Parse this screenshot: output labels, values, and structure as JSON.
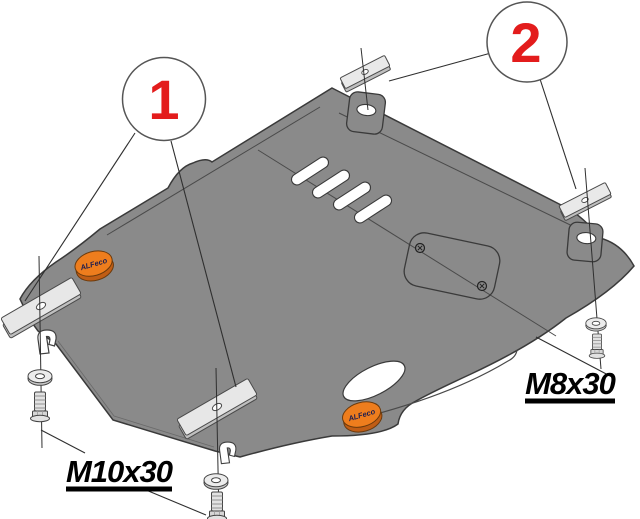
{
  "diagram": {
    "background_color": "#ffffff",
    "plate_color": "#8a8a8a",
    "hardware_color": "#e7e7e7",
    "line_color": "#2f2f2f",
    "callouts": [
      {
        "number": "1",
        "color": "#e31c1c"
      },
      {
        "number": "2",
        "color": "#e31c1c"
      }
    ],
    "fastener_labels": [
      {
        "text": "M10x30"
      },
      {
        "text": "M8x30"
      }
    ],
    "brand_logos": [
      {
        "text": "ALFeco",
        "color": "#ee7d1d"
      },
      {
        "text": "ALFeco",
        "color": "#ee7d1d"
      }
    ]
  }
}
